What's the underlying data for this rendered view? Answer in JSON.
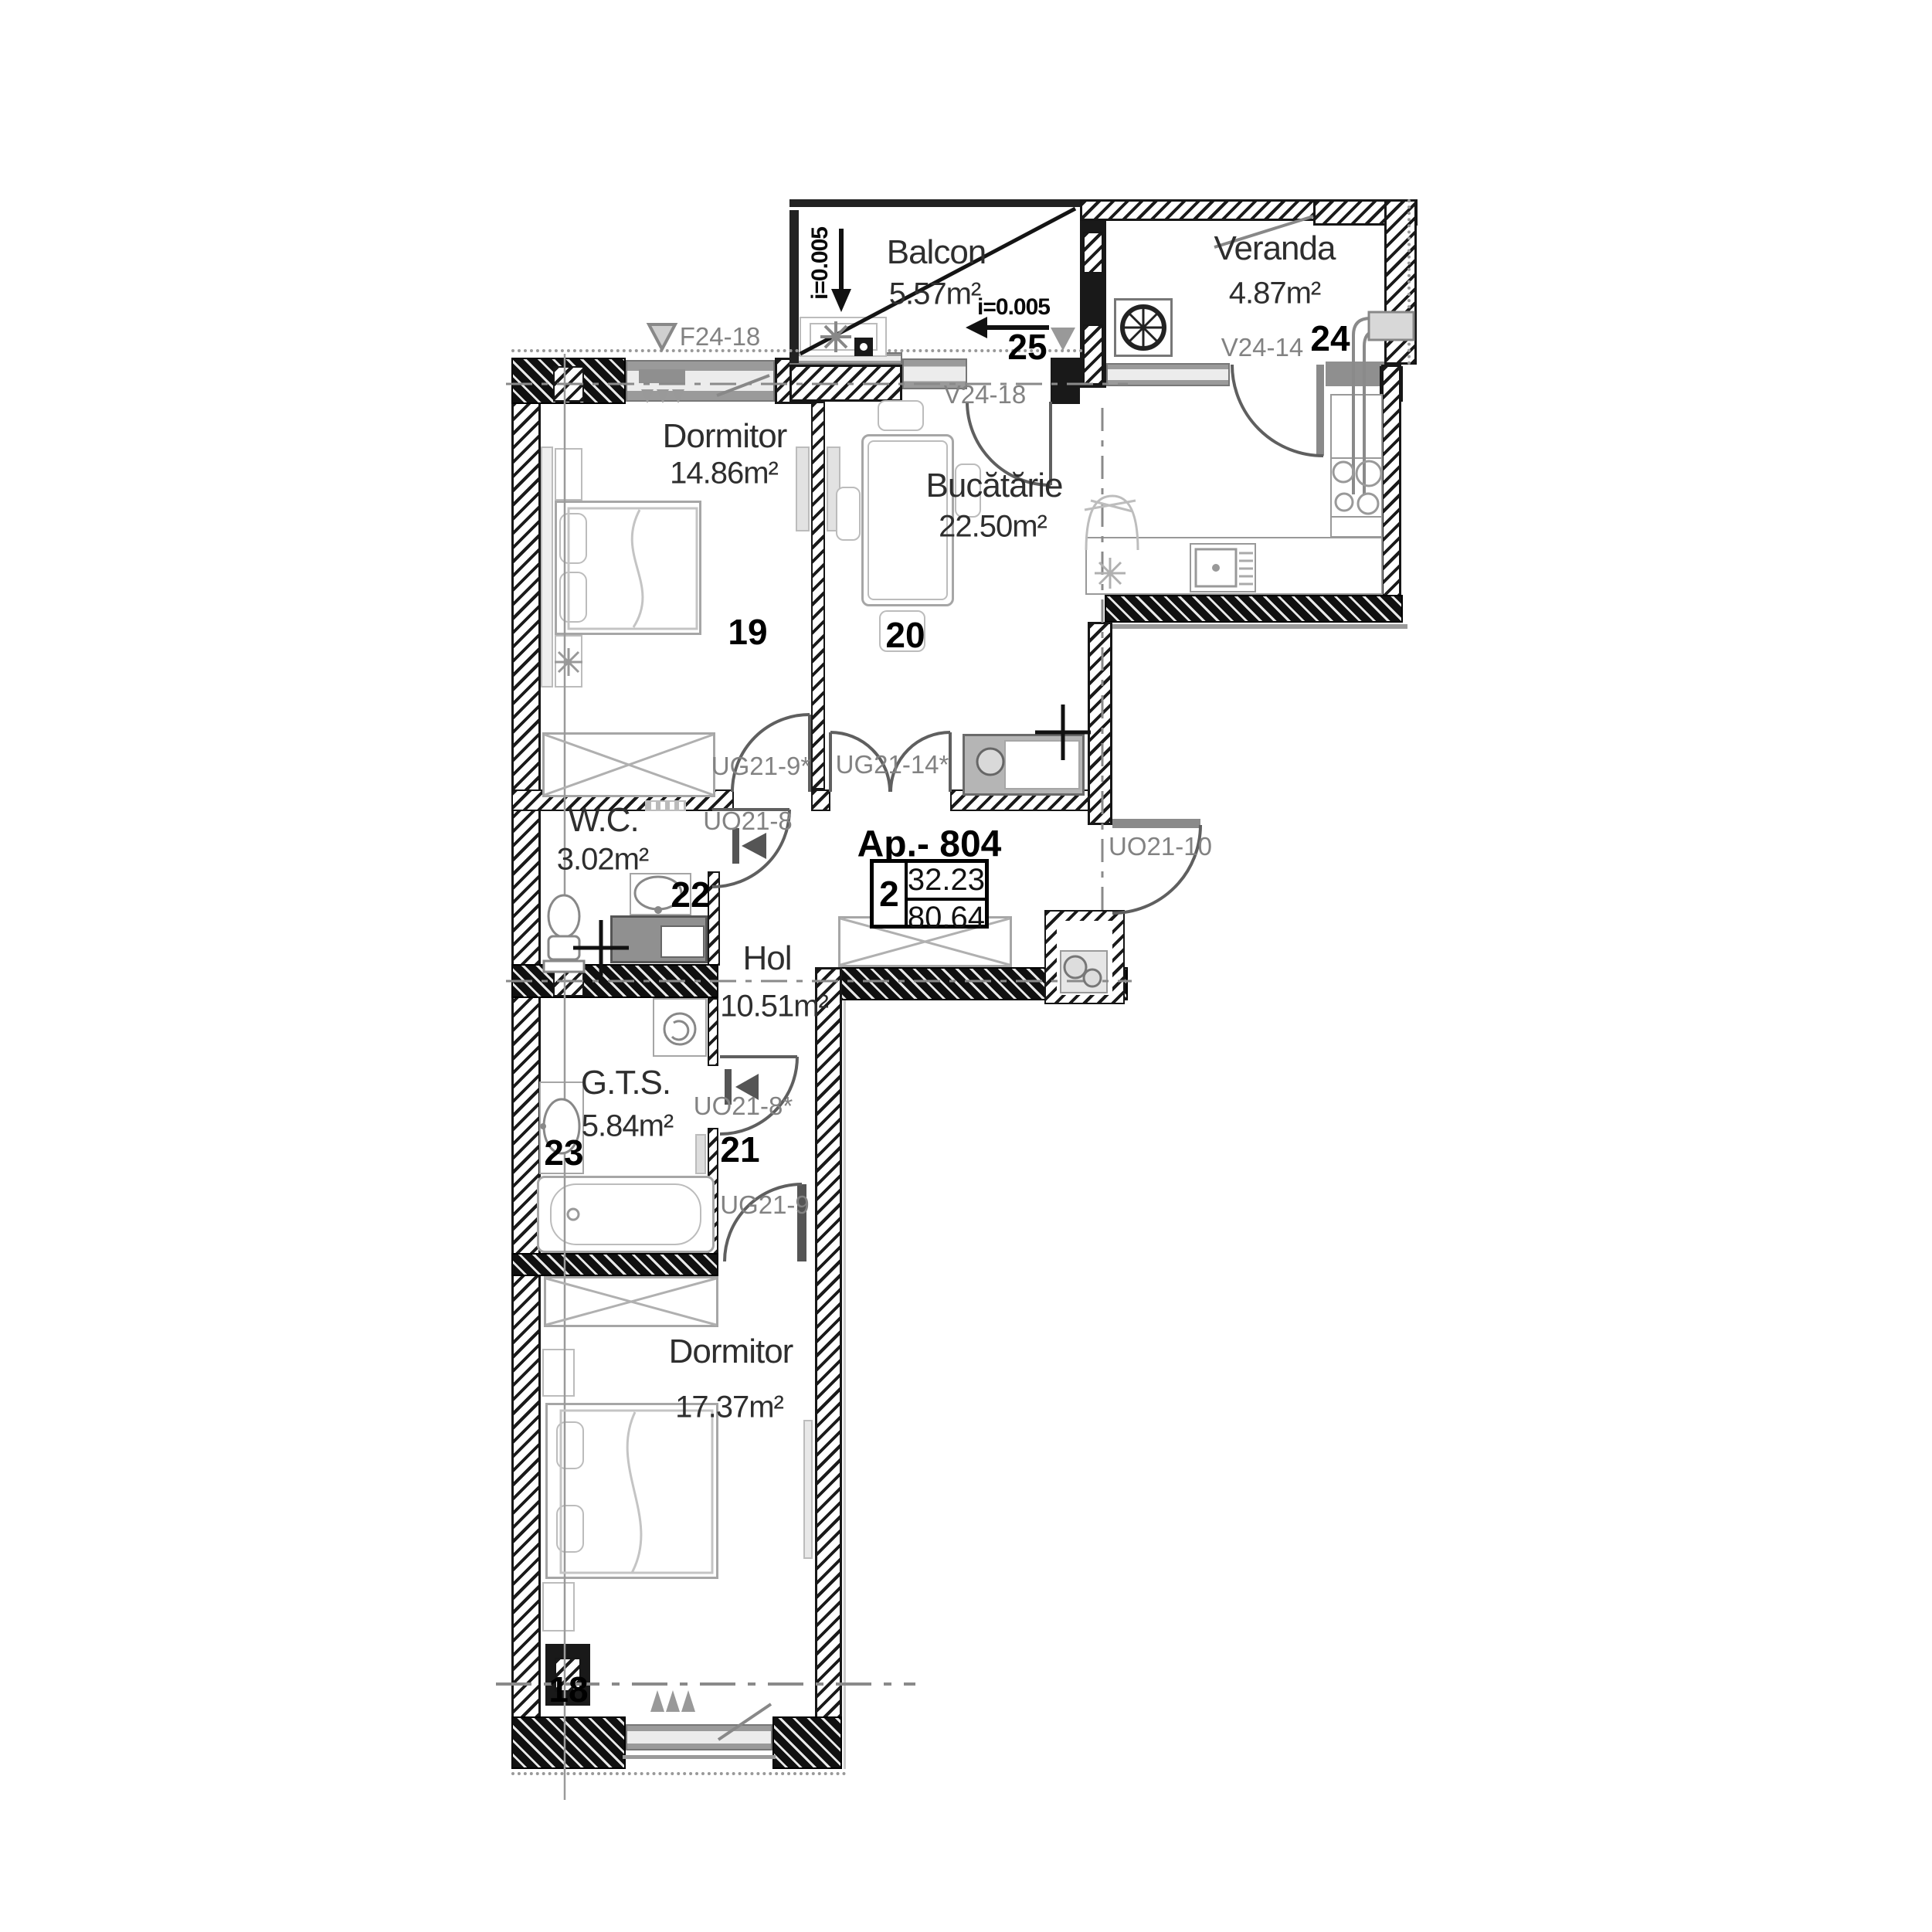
{
  "plan": {
    "apartment": {
      "label": "Ap.- 804",
      "rooms_count": "2",
      "area_top": "32.23",
      "area_bottom": "80.64"
    },
    "rooms": [
      {
        "id": "balcon",
        "name": "Balcon",
        "area": "5.57m²",
        "number": "25"
      },
      {
        "id": "veranda",
        "name": "Veranda",
        "area": "4.87m²",
        "number": "24"
      },
      {
        "id": "dormitor1",
        "name": "Dormitor",
        "area": "14.86m²",
        "number": "19"
      },
      {
        "id": "bucatarie",
        "name": "Bucătărie",
        "area": "22.50m²",
        "number": "20"
      },
      {
        "id": "wc",
        "name": "W.C.",
        "area": "3.02m²",
        "number": "22"
      },
      {
        "id": "hol",
        "name": "Hol",
        "area": "10.51m²",
        "number": "21"
      },
      {
        "id": "gts",
        "name": "G.T.S.",
        "area": "5.84m²",
        "number": "23"
      },
      {
        "id": "dormitor2",
        "name": "Dormitor",
        "area": "17.37m²",
        "number": "18"
      }
    ],
    "codes": {
      "f24_18": "F24-18",
      "v24_18": "V24-18",
      "v24_14": "V24-14",
      "ug21_9s": "UG21-9*",
      "ug21_14s": "UG21-14*",
      "uo21_8": "UO21-8",
      "uo21_8s": "UO21-8*",
      "uo21_10": "UO21-10",
      "ug21_9": "UG21-9"
    },
    "slopes": {
      "vertical": "i=0.005",
      "horizontal": "i=0.005"
    },
    "colors": {
      "wall": "#161616",
      "code_text": "#828282",
      "room_text": "#2e2e2e",
      "line": "#5f5f5f"
    }
  }
}
